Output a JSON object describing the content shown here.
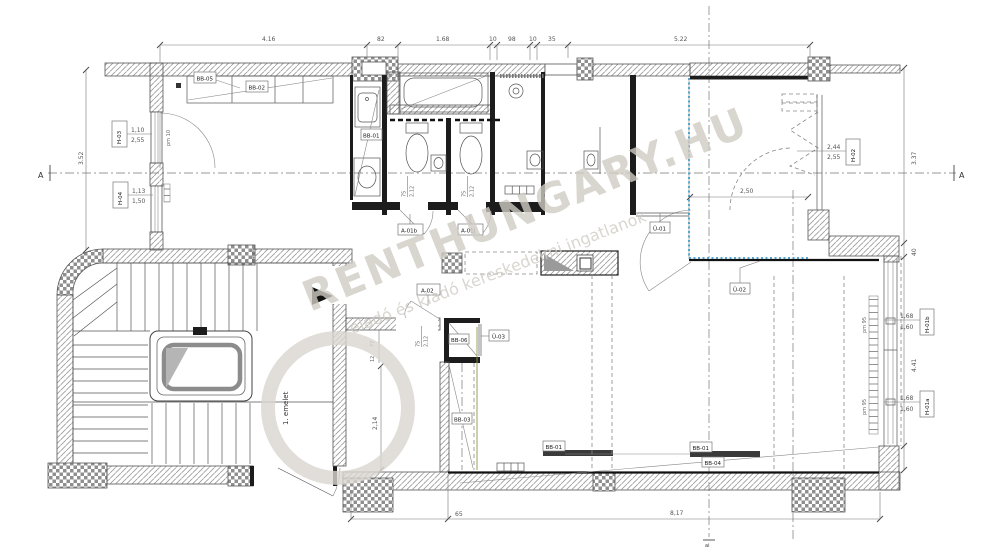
{
  "plan": {
    "floor_label": "1. emelet",
    "section_a": "A",
    "grid_label": "ai",
    "watermark": {
      "brand": "RENTHUNGARY.HU",
      "tagline": "eladó és kiadó kereskedelmi ingatlanok"
    },
    "dims": {
      "top": {
        "d1": "4.16",
        "d2": "82",
        "d3": "1.68",
        "d4": "10",
        "d5": "98",
        "d6": "10",
        "d7": "35",
        "d8": "5.22"
      },
      "left_overall": "3.52",
      "right": {
        "r1": "3.37",
        "r2": "40",
        "r3": "4.41"
      },
      "bottom": {
        "b1": "65",
        "b2": "8,17"
      },
      "interior": {
        "w250": "2,50",
        "h214": "2,14",
        "n77": "77",
        "n12": "12"
      }
    },
    "win": {
      "h03": {
        "tag": "H-03",
        "a": "1,10",
        "b": "2,55",
        "pm": "pm 10"
      },
      "h04": {
        "tag": "H-04",
        "a": "1,13",
        "b": "1,50"
      },
      "h02": {
        "tag": "H-02",
        "a": "2,44",
        "b": "2,55"
      },
      "h01b": {
        "tag": "H-01b",
        "a": "1,68",
        "b": "1,60",
        "pm": "pm 95"
      },
      "h01a": {
        "tag": "H-01a",
        "a": "1,68",
        "b": "1,60",
        "pm": "pm 95"
      }
    },
    "door": {
      "a01b": {
        "tag": "A-01b",
        "w": "75",
        "h": "2,12"
      },
      "a01j": {
        "tag": "A-01j",
        "w": "75",
        "h": "2,12"
      },
      "a02": {
        "tag": "A-02",
        "w": "75",
        "h": "2,12"
      }
    },
    "glass": {
      "u01": "Ü-01",
      "u02": "Ü-02",
      "u03": "Ü-03"
    },
    "furn": {
      "bb01": "BB-01",
      "bb02": "BB-02",
      "bb03": "BB-03",
      "bb04": "BB-04",
      "bb05": "BB-05",
      "bb06": "BB-06"
    }
  }
}
